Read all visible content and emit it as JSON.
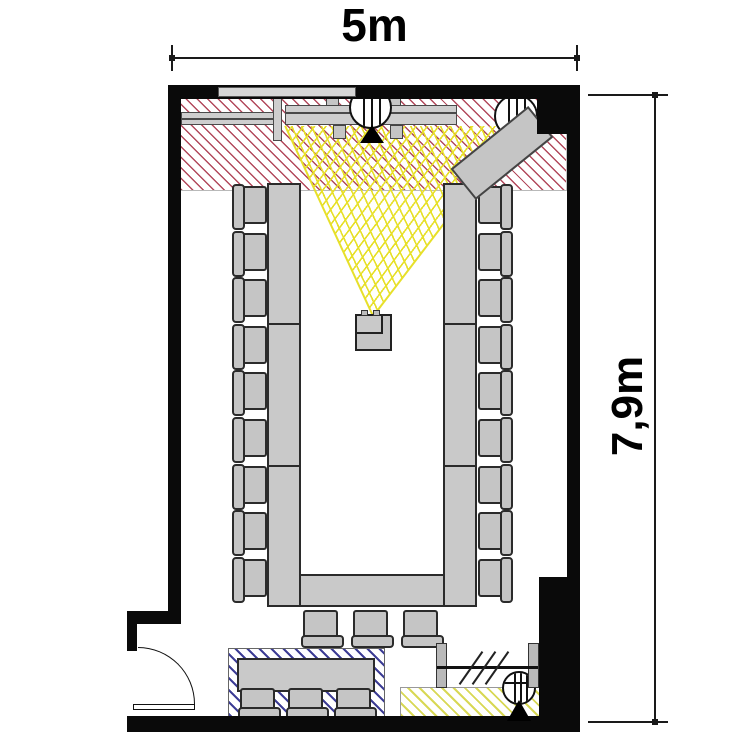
{
  "title": "Meeting room floor plan, U-shape seating",
  "dimensions": {
    "width_label": "5m",
    "height_label": "7,9m"
  },
  "colors": {
    "wall": "#0a0a0a",
    "furniture_fill": "#c5c5c5",
    "furniture_border": "#2b2b2b",
    "presentation_hatch": "#b2495c",
    "projection_yellow": "#e7e02a",
    "buffet_hatch": "#3d3d95",
    "floor_hatch_yellow": "#d8d855"
  },
  "zones": [
    {
      "name": "presentation-zone",
      "hatch_color_key": "presentation_hatch"
    },
    {
      "name": "buffet-zone",
      "hatch_color_key": "buffet_hatch"
    },
    {
      "name": "equipment-zone",
      "hatch_color_key": "floor_hatch_yellow"
    },
    {
      "name": "projection-beam",
      "hatch_color_key": "projection_yellow"
    }
  ],
  "fixtures": [
    "projection-screen",
    "whiteboard",
    "wall-rail",
    "flipchart",
    "ceiling-fixture-top-center",
    "ceiling-fixture-top-right",
    "ceiling-fixture-bottom-right",
    "projector",
    "speaker-position-marker-top",
    "speaker-position-marker-bottom",
    "door",
    "partition-rail"
  ],
  "seating": {
    "u_table_seats": 21,
    "buffet_seats": 3
  },
  "layout": {
    "tables": [
      {
        "name": "u-table-left",
        "x": 267,
        "y": 183,
        "w": 34,
        "h": 424
      },
      {
        "name": "u-table-right",
        "x": 443,
        "y": 183,
        "w": 34,
        "h": 424
      },
      {
        "name": "u-table-bottom",
        "x": 299,
        "y": 574,
        "w": 146,
        "h": 33
      },
      {
        "name": "buffet-table",
        "x": 237,
        "y": 658,
        "w": 138,
        "h": 34
      }
    ],
    "table_seams": [
      {
        "x": 267,
        "y": 323,
        "w": 34
      },
      {
        "x": 267,
        "y": 465,
        "w": 34
      },
      {
        "x": 443,
        "y": 323,
        "w": 34
      },
      {
        "x": 443,
        "y": 465,
        "w": 34
      }
    ],
    "chair_groups": [
      {
        "name": "left-row",
        "facing": "right",
        "x": 236,
        "y": 186,
        "w": 31,
        "h": 38,
        "count": 9,
        "dx": 0,
        "dy": 46.6
      },
      {
        "name": "right-row",
        "facing": "left",
        "x": 478,
        "y": 186,
        "w": 31,
        "h": 38,
        "count": 9,
        "dx": 0,
        "dy": 46.6
      },
      {
        "name": "bottom-row",
        "facing": "up",
        "x": 303,
        "y": 610,
        "w": 35,
        "h": 34,
        "count": 3,
        "dx": 50,
        "dy": 0
      },
      {
        "name": "buffet-row",
        "facing": "up",
        "x": 240,
        "y": 688,
        "w": 35,
        "h": 28,
        "count": 3,
        "dx": 48,
        "dy": 0
      }
    ]
  }
}
